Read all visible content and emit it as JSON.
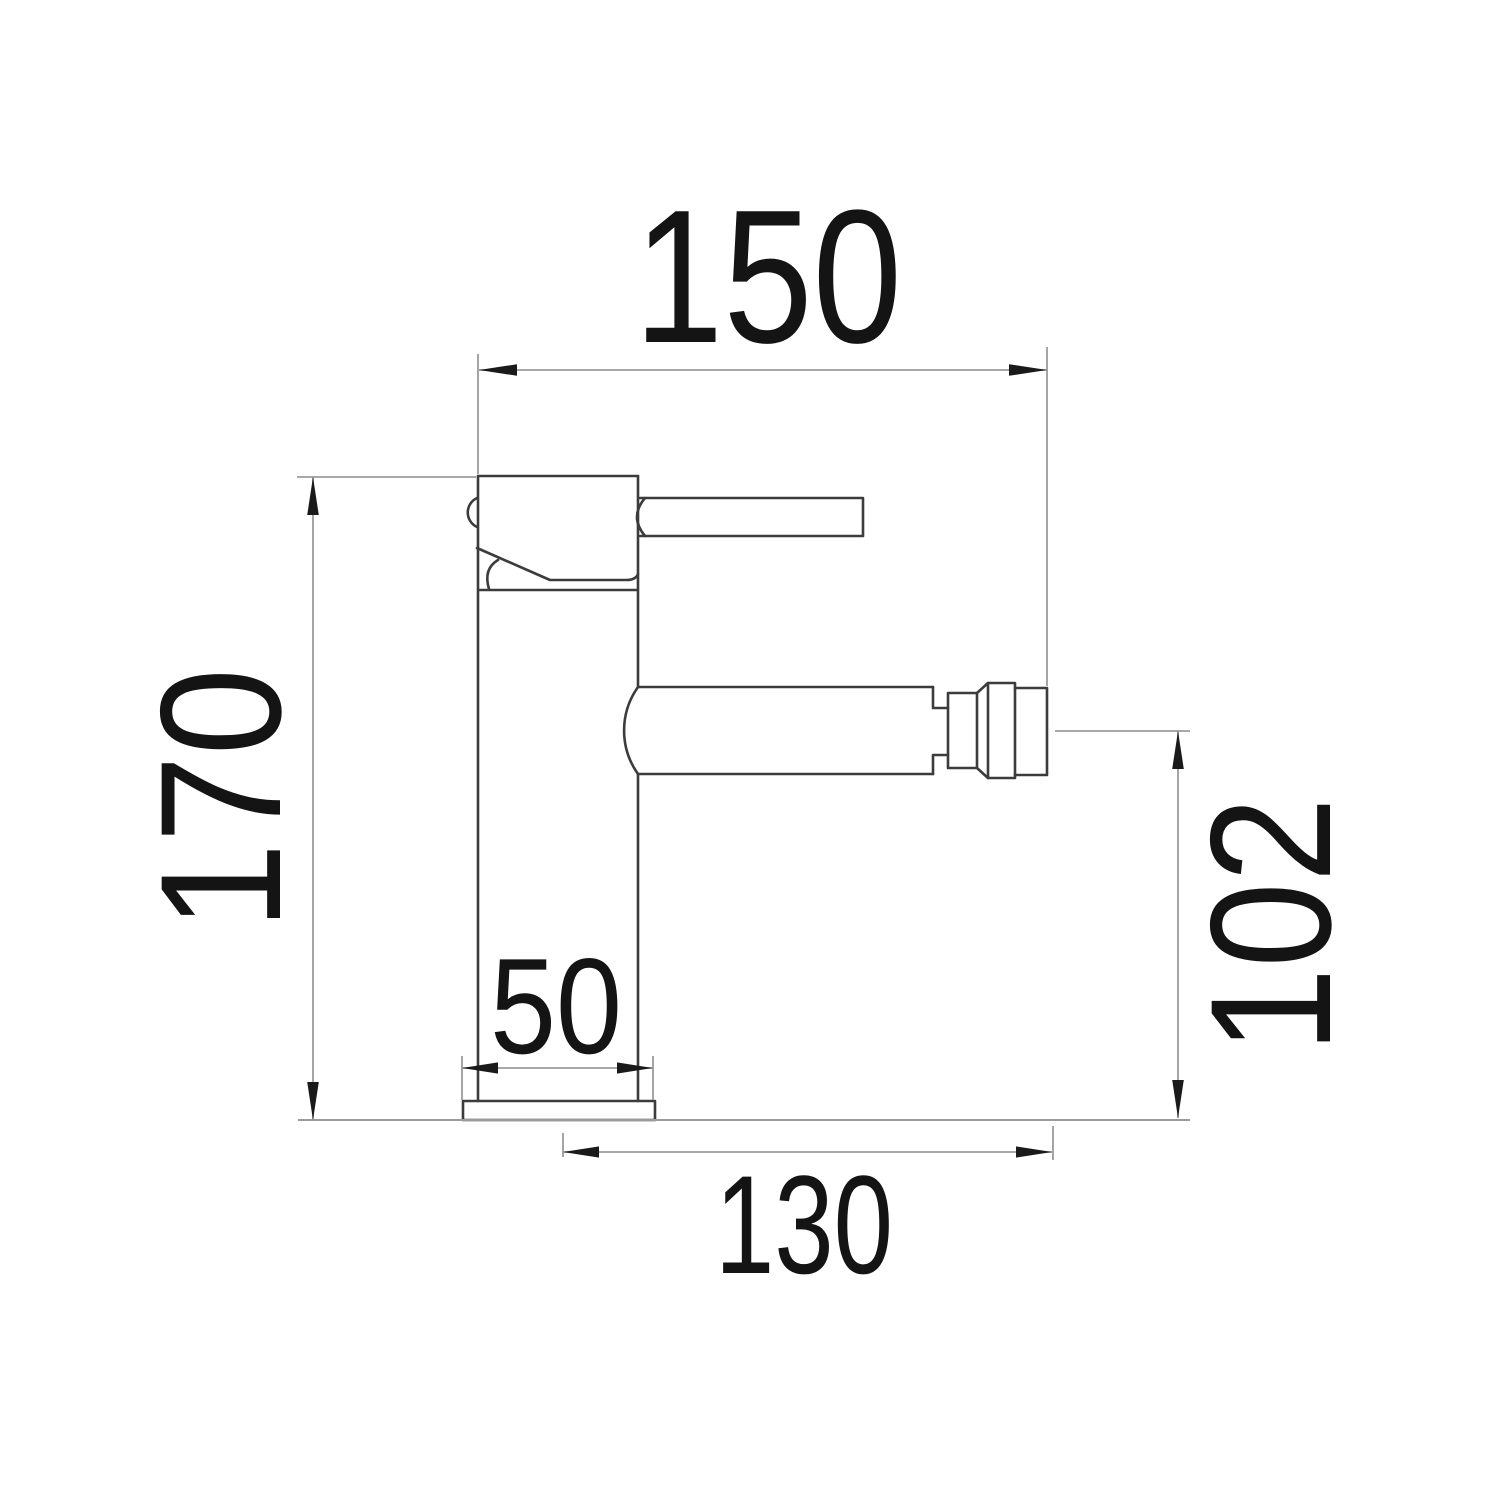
{
  "drawing": {
    "kind": "technical dimension drawing",
    "subject": "single-lever mixer tap, side elevation",
    "units_implied": "mm",
    "background": "#ffffff",
    "colors": {
      "outline": "#3c3c3c",
      "dimension_lines": "#9b9b9b",
      "arrowheads": "#1a1a1a",
      "text": "#141414"
    },
    "dimensions": {
      "top_width": {
        "value": "150"
      },
      "left_height": {
        "value": "170"
      },
      "right_height": {
        "value": "102"
      },
      "base_width": {
        "value": "50"
      },
      "bottom_reach": {
        "value": "130"
      }
    }
  }
}
